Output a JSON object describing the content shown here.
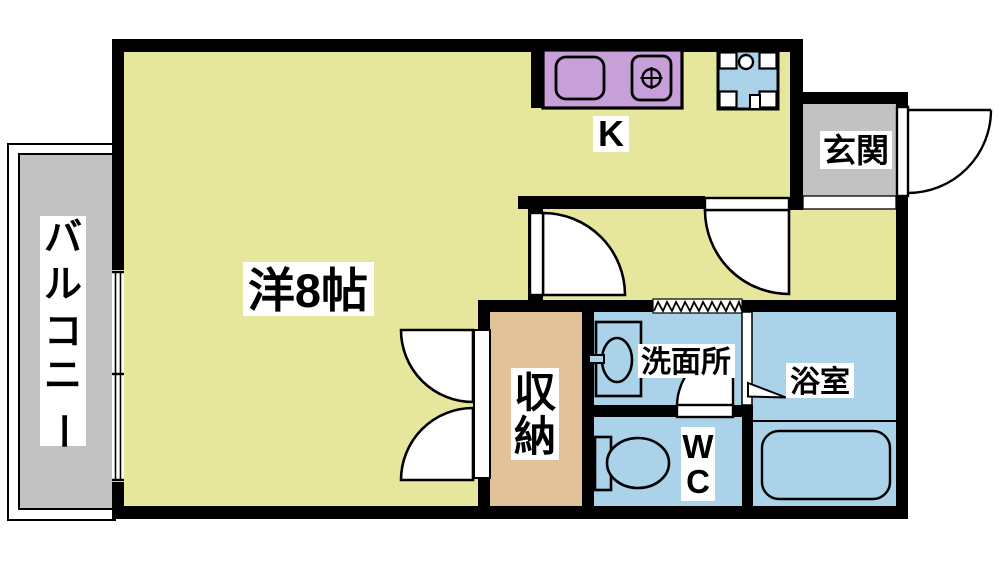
{
  "labels": {
    "main_room": "洋8帖",
    "kitchen": "K",
    "entrance": "玄関",
    "balcony": "バルコニー",
    "balcony_chars": [
      "バ",
      "ル",
      "コ",
      "ニ",
      "ー"
    ],
    "storage": "収納",
    "storage_chars": [
      "収",
      "納"
    ],
    "washroom": "洗面所",
    "bathroom": "浴室",
    "wc": "WC",
    "wc_chars": [
      "W",
      "C"
    ]
  },
  "colors": {
    "room_yellow": "#e6e79c",
    "water_blue": "#aad2e8",
    "counter_purple": "#c79fd9",
    "storage_tan": "#e2c298",
    "concrete_gray": "#c2c2c2",
    "wall_black": "#000000",
    "label_bg": "#ffffff"
  }
}
